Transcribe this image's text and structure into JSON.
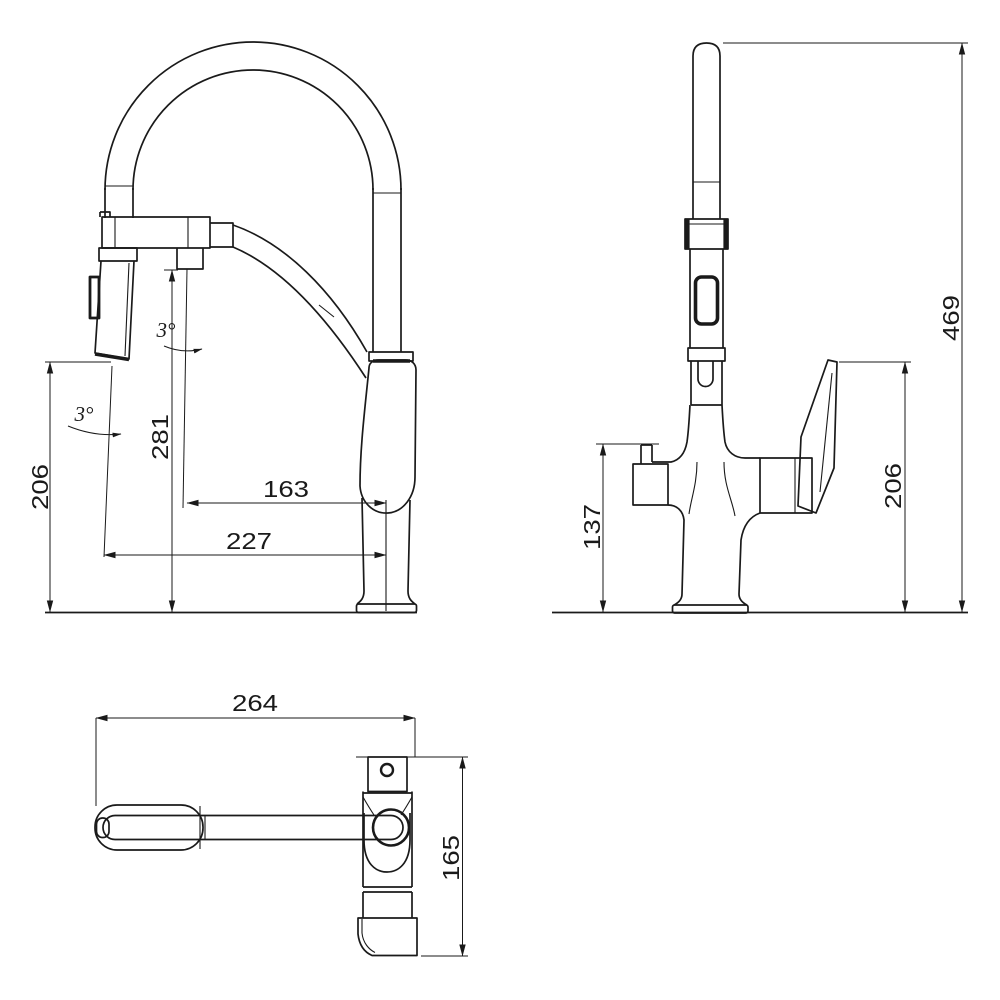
{
  "colors": {
    "line": "#1a1a1a",
    "background": "#ffffff"
  },
  "side_view": {
    "spray_outlet_height": "206",
    "hose_holder_height": "281",
    "spout_center_reach": "163",
    "spray_center_reach": "227",
    "spray_tilt_angle": "3°",
    "holder_tilt_angle": "3°"
  },
  "front_view": {
    "overall_height": "469",
    "handle_tip_height": "206",
    "side_outlet_height": "137"
  },
  "top_view": {
    "overall_length": "264",
    "base_depth": "165"
  }
}
